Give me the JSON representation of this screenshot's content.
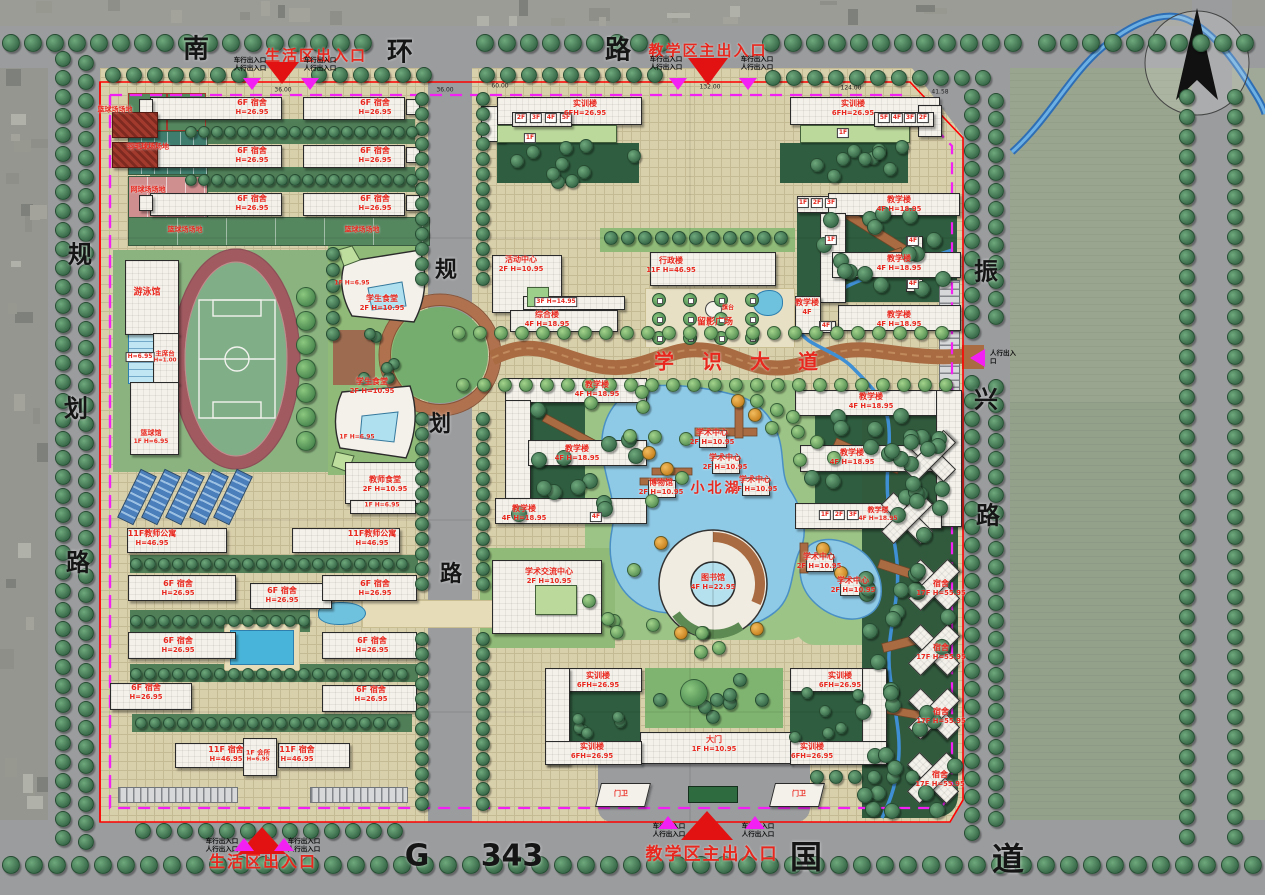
{
  "roads": {
    "top": [
      "南",
      "环",
      "路"
    ],
    "left": [
      "规",
      "划",
      "路"
    ],
    "center": [
      "规",
      "划",
      "路"
    ],
    "right": [
      "振",
      "兴",
      "路"
    ],
    "bottom": [
      "G",
      "343",
      "国",
      "道"
    ]
  },
  "avenue": [
    "学",
    "识",
    "大",
    "道"
  ],
  "lake": "小北湖",
  "entrances": {
    "life": "生活区出入口",
    "teach": "教学区主出入口",
    "vehicle": "车行出入口",
    "ped": "人行出入口"
  },
  "plaza": {
    "name": "留影广场",
    "flag": "旗台"
  },
  "labels": {
    "dorm6": {
      "name": "6F 宿舍",
      "spec": "H=26.95"
    },
    "dorm11": {
      "name": "11F 宿舍",
      "spec": "H=46.95"
    },
    "dorm17": {
      "name": "宿舍",
      "spec": "17F H=55.95"
    },
    "club": {
      "name": "1F 会所",
      "spec": "H=6.95"
    },
    "tapt": {
      "name": "11F教师公寓",
      "spec": "H=46.95"
    },
    "teach": {
      "name": "教学楼",
      "spec": "4F H=18.95"
    },
    "teach2": {
      "name": "教学楼",
      "spec": "4F"
    },
    "train": {
      "name": "实训楼",
      "spec": "6FH=26.95"
    },
    "admin": {
      "name": "行政楼",
      "spec": "11F H=46.95"
    },
    "lib": {
      "name": "图书馆",
      "spec": "4F H=22.95"
    },
    "acad": {
      "name": "学术中心",
      "spec": "2F H=10.95"
    },
    "museum": {
      "name": "博物馆",
      "spec": "2F H=10.95"
    },
    "exch": {
      "name": "学术交流中心",
      "spec": "2F H=10.95"
    },
    "scant": {
      "name": "学生食堂",
      "spec": "2F H=10.95"
    },
    "tcant": {
      "name": "教师食堂",
      "spec": "2F H=10.95"
    },
    "act": {
      "name": "活动中心",
      "spec": "2F H=10.95"
    },
    "comp": {
      "name": "综合楼",
      "spec": "4F H=18.95"
    },
    "gate": {
      "name": "大门",
      "spec": "1F H=10.95"
    },
    "guard": {
      "name": "门卫"
    },
    "swim": {
      "name": "游泳馆"
    },
    "rostrum": {
      "name": "主席台",
      "spec": "H=1.00"
    },
    "bhall": {
      "name": "篮球馆",
      "spec": "1F H=6.95"
    },
    "f1h": {
      "name": "1F H=6.95"
    },
    "bball": {
      "name": "篮球场场地"
    },
    "badminton": {
      "name": "羽毛球场场地"
    },
    "tennis": {
      "name": "网球场场地"
    }
  },
  "chips": {
    "f1": "1F",
    "f2": "2F",
    "f3": "3F",
    "f4": "4F",
    "f5": "5F",
    "f3h": "3F H=14.95",
    "ph": "H=6.95"
  },
  "dims": [
    "36.00",
    "60.00",
    "132.00",
    "124.00",
    "41.58",
    "36.00"
  ],
  "colors": {
    "red": "#e8281e",
    "magenta": "#f320f3",
    "boundary": "#ff0000",
    "lake": "#8ecae6"
  }
}
